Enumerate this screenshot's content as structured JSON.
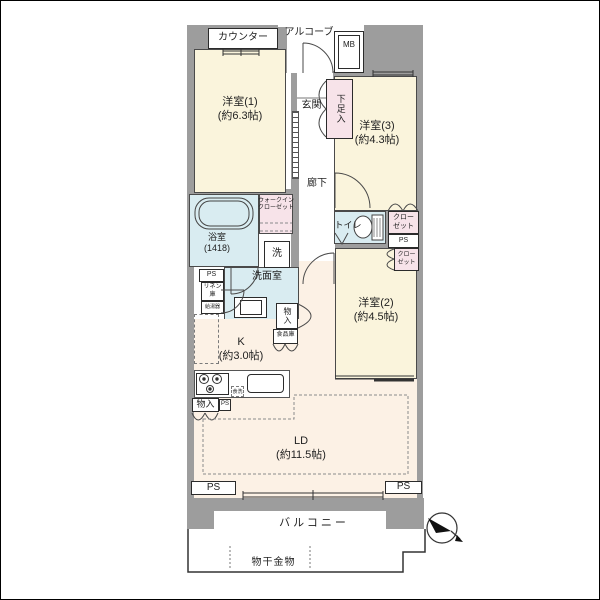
{
  "floorplan": {
    "rooms": {
      "western1": {
        "name": "洋室(1)",
        "size": "(約6.3帖)"
      },
      "western2": {
        "name": "洋室(2)",
        "size": "(約4.5帖)"
      },
      "western3": {
        "name": "洋室(3)",
        "size": "(約4.3帖)"
      },
      "ld": {
        "name": "LD",
        "size": "(約11.5帖)"
      },
      "kitchen": {
        "name": "K",
        "size": "(約3.0帖)"
      },
      "bathroom": {
        "name": "浴室",
        "size": "(1418)"
      },
      "washroom": {
        "name": "洗面室"
      },
      "toilet": {
        "name": "トイレ"
      },
      "corridor": {
        "name": "廊下"
      },
      "genkan": {
        "name": "玄関"
      },
      "balcony": {
        "name": "バルコニー"
      }
    },
    "storage": {
      "wic_line1": "ウォークイン",
      "wic_line2": "クローゼット",
      "closet_line1": "クロー",
      "closet_line2": "ゼット",
      "shoe_cabinet": "下足入",
      "linen_line1": "リネン",
      "linen_line2": "庫",
      "storage": "物入",
      "pantry": "食品庫"
    },
    "fixtures": {
      "counter": "カウンター",
      "alcove": "アルコーブ",
      "meter_box": "MB",
      "laundry_machine": "洗",
      "water_heater": "給湯器",
      "dishwasher": "食洗",
      "laundry_hardware": "物干金物",
      "pipe_space": "PS"
    },
    "colors": {
      "room_cream": "#FAF4DC",
      "ldk_cream": "#FCF1E5",
      "wet_area_blue": "#D9ECF1",
      "closet_pink": "#F7E3E9",
      "wall_gray": "#9D9D9D"
    }
  }
}
